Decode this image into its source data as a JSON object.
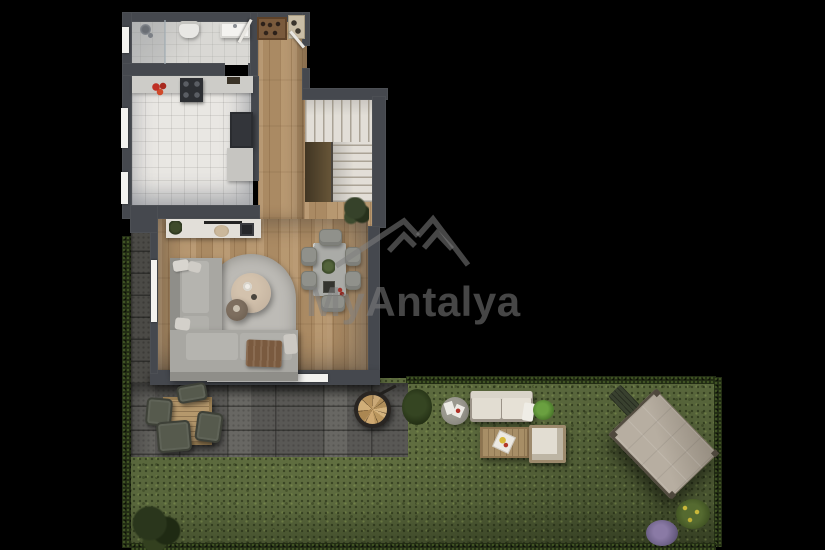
{
  "meta": {
    "kind": "top-down 3D floor-plan render with garden",
    "visible_text_only": "watermark"
  },
  "watermark": {
    "brand": "MyAntalya",
    "logo": "double-mountain-peaks-logo"
  },
  "palette": {
    "background": "#000000",
    "wall": "#45484e",
    "wood_floor": "#b3926a",
    "tile_floor": "#e9e7e3",
    "bath_floor": "#d9d8d4",
    "rug": "#bdbbb6",
    "sofa": "#a8a7a2",
    "coffee_table": "#c8b7a3",
    "patio_paver": "#605f5b",
    "lawn": "#59673c",
    "hedge": "#222c14",
    "canopy": "#b7aea1",
    "fire_pit_logs": "#c4a170",
    "outdoor_cushion": "#e2ddd2",
    "outdoor_table_wood": "#a78e66",
    "watermark_gray": "#808080"
  },
  "rooms": [
    {
      "name": "bathroom",
      "features": [
        "shower-head",
        "glass-partition",
        "toilet",
        "sink",
        "open-door",
        "window"
      ]
    },
    {
      "name": "entry-hall",
      "features": [
        "shoe-rack",
        "doormat",
        "entry-door-open"
      ]
    },
    {
      "name": "kitchen",
      "features": [
        "counter",
        "cooktop",
        "tomatoes",
        "tall-appliance-column",
        "side-counter",
        "two-windows"
      ]
    },
    {
      "name": "staircase",
      "features": [
        "winder-steps",
        "straight-flight",
        "under-stair-shadow"
      ]
    },
    {
      "name": "living-room",
      "features": [
        "sideboard",
        "soundbar",
        "tv-frame",
        "corner-sofa",
        "pillows",
        "brown-throw",
        "arched-rug",
        "round-coffee-table",
        "round-side-table",
        "dining-table",
        "six-chairs",
        "houseplant",
        "side-window",
        "terrace-sliding-door"
      ]
    }
  ],
  "garden": {
    "areas": [
      "paved-terrace",
      "side-path",
      "lawn",
      "hedges"
    ],
    "furniture": [
      "outdoor-dining-table",
      "four-outdoor-chairs",
      "fire-pit-with-poker",
      "garden-sofa",
      "garden-coffee-table-with-tray",
      "garden-armchair",
      "round-glass-side-table-with-cards",
      "rotated-canopy-pavilion",
      "bench-at-canopy"
    ],
    "plants": [
      "bush-by-firepit",
      "bush-by-sofa",
      "large-shrub-bottom-left",
      "purple-bush",
      "yellow-green-bush"
    ]
  }
}
